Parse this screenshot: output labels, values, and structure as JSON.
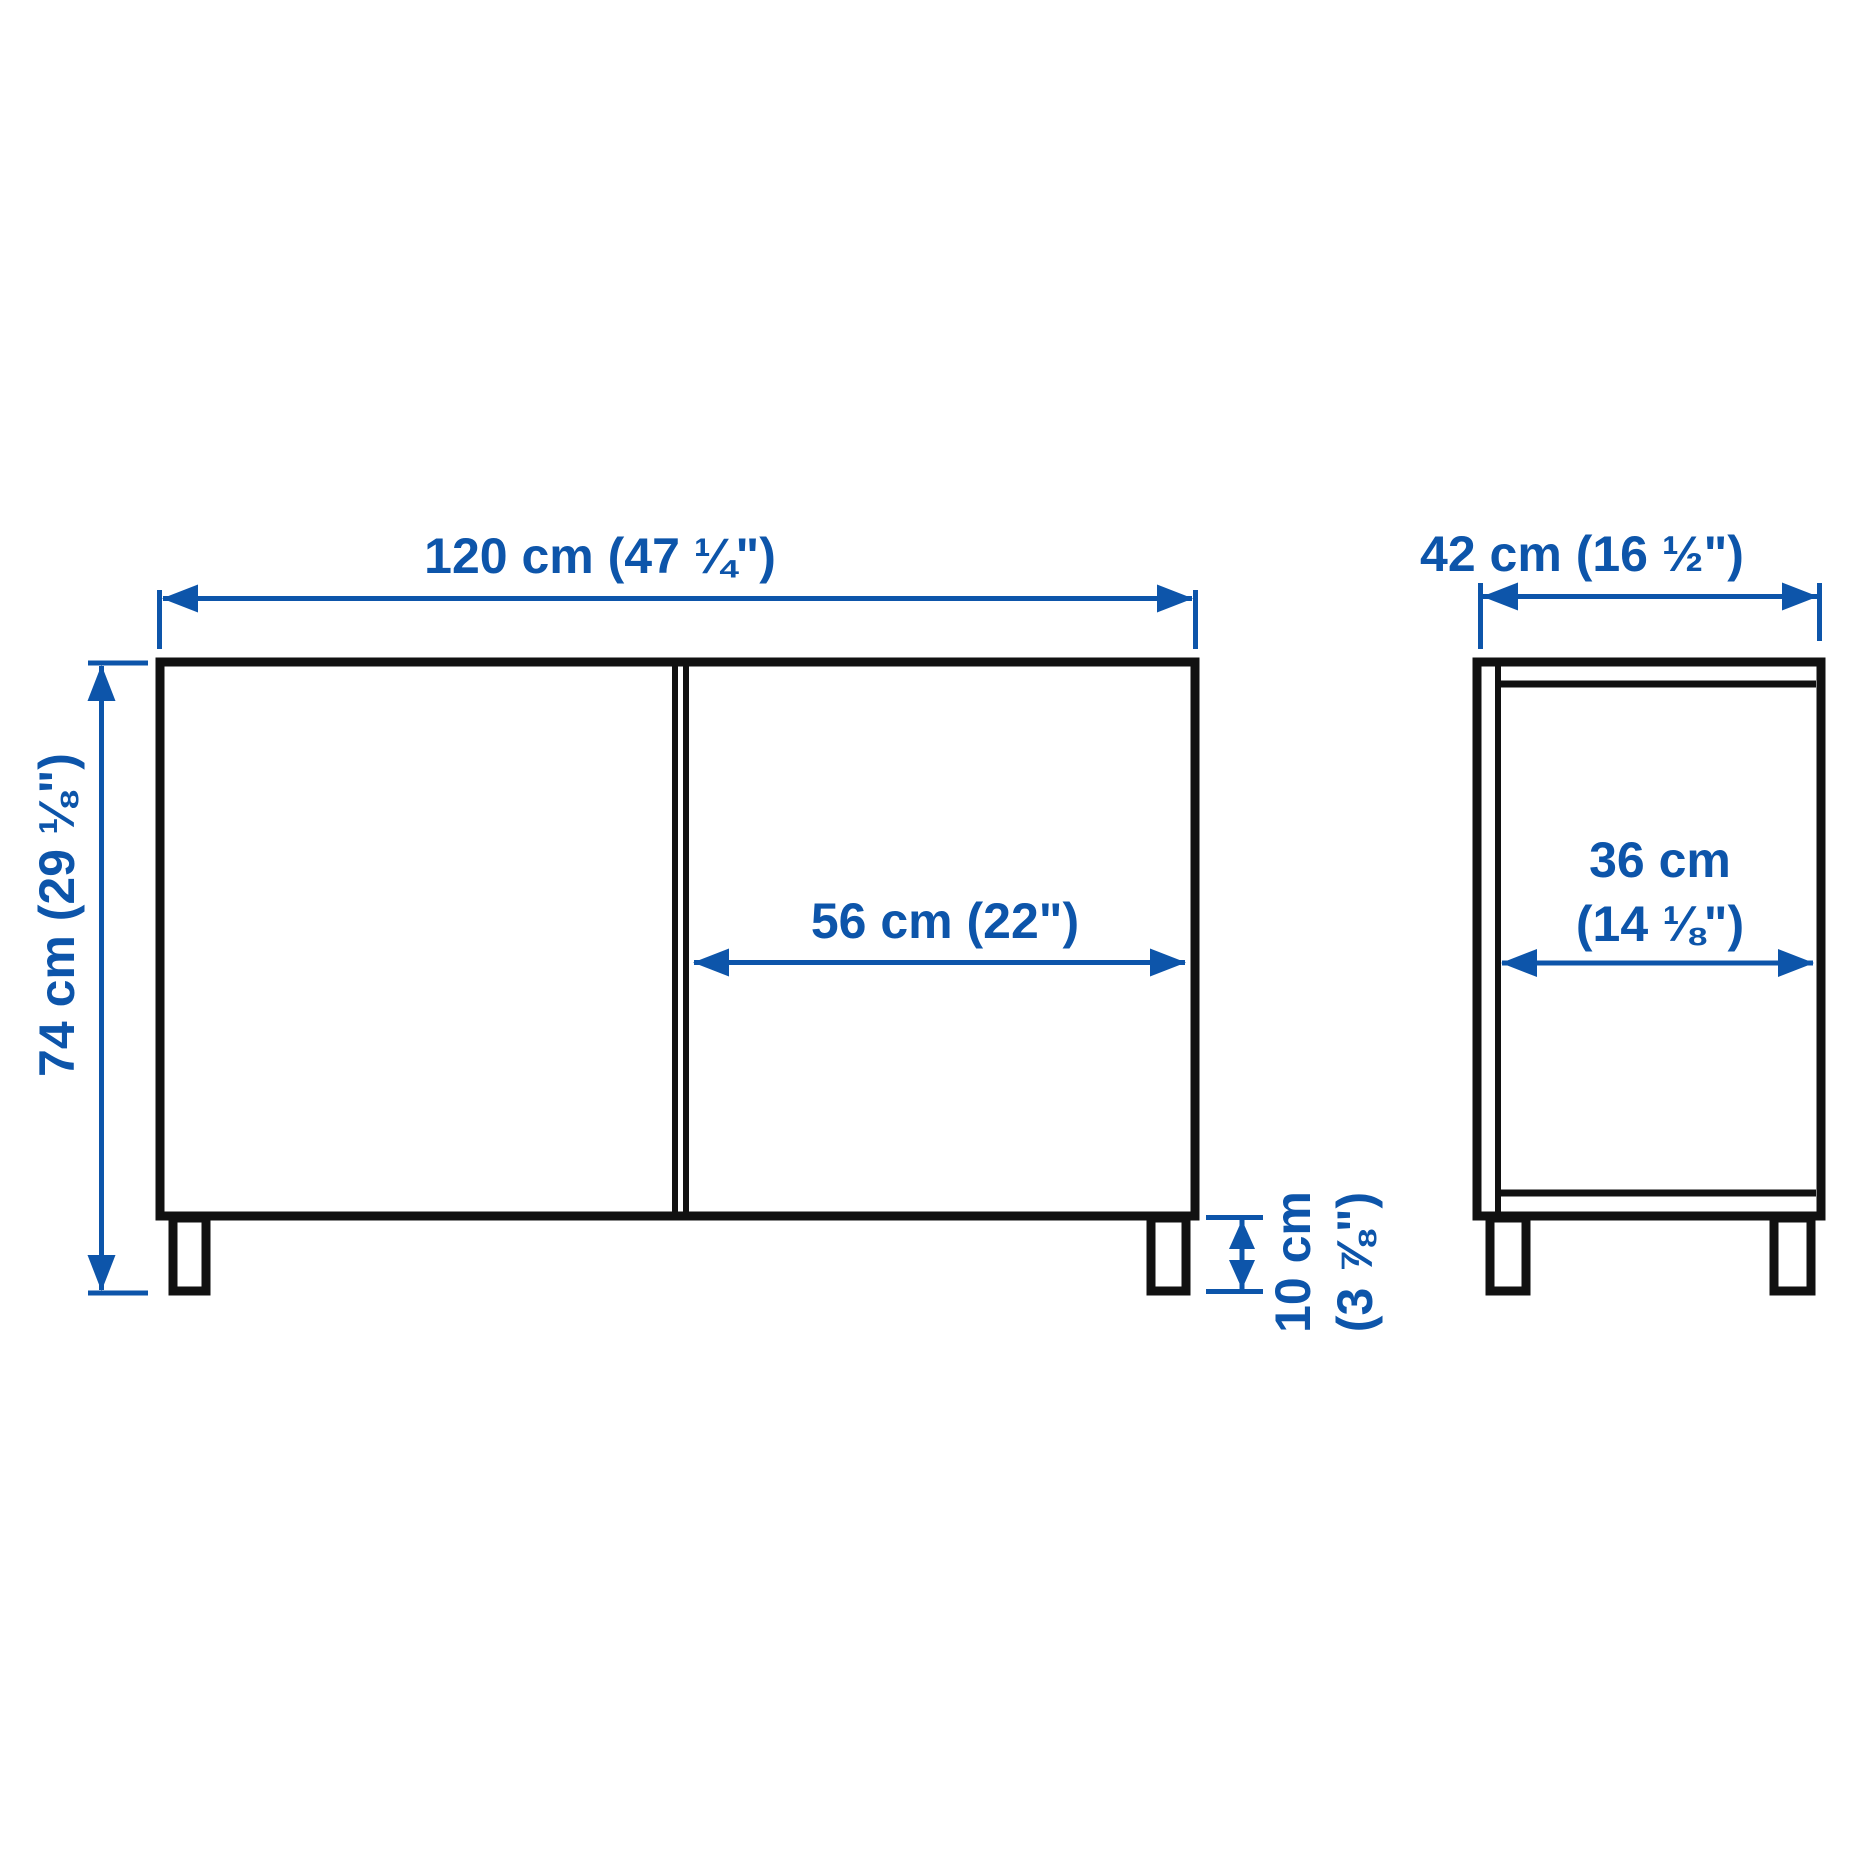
{
  "diagram": {
    "kind": "furniture-dimension-diagram",
    "colors": {
      "dimension_blue": "#0d55aa",
      "outline_black": "#111111",
      "background": "#ffffff"
    },
    "front_view": {
      "width_label": "120 cm (47 ¼\")",
      "height_label": "74 cm (29 ⅛\")",
      "door_width_label": "56 cm (22\")",
      "leg_height_label_line1": "10 cm",
      "leg_height_label_line2": "(3 ⅞\")"
    },
    "side_view": {
      "depth_label": "42 cm (16 ½\")",
      "inner_depth_label_line1": "36 cm",
      "inner_depth_label_line2": "(14 ⅛\")"
    }
  }
}
